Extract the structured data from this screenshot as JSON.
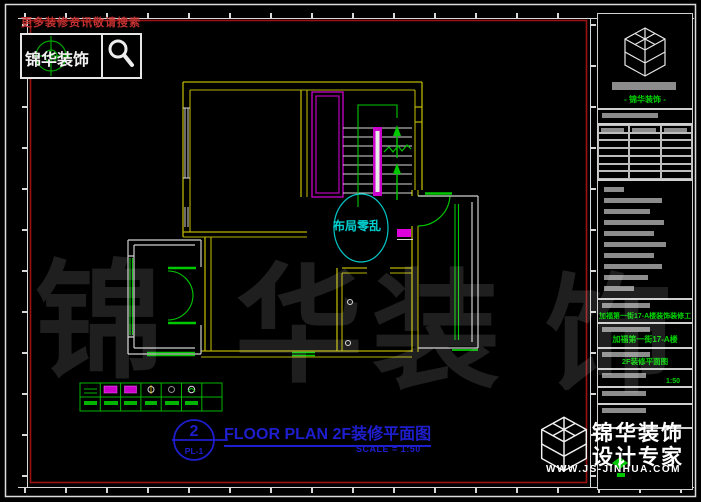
{
  "promo": {
    "text": "更多装修资讯敬请搜索"
  },
  "logo": {
    "name": "锦华装饰"
  },
  "plan": {
    "annotation": "布局零乱"
  },
  "sheet": {
    "number": "2",
    "ref": "PL-1",
    "title": "FLOOR PLAN 2F装修平面图",
    "scale": "SCALE = 1:50"
  },
  "title_block": {
    "brand": "- 锦华装饰 -",
    "project": "加福第一街17-A楼装饰装修工程",
    "address": "加福第一街17-A楼",
    "drawing": "2F装修平面图",
    "scale": "1:50"
  },
  "watermark": {
    "chars": [
      "锦",
      "华",
      "装",
      "饰"
    ],
    "brand_top": "锦华装饰",
    "brand_bottom": "设计专家",
    "url": "WWW.JS-JINHUA.COM"
  },
  "colors": {
    "wall_yellow": "#b9b300",
    "accent_green": "#00c800",
    "magenta": "#cc00cc",
    "cyan": "#00c8c8",
    "title_blue": "#1e1ecf",
    "frame_red": "#9b1212"
  }
}
